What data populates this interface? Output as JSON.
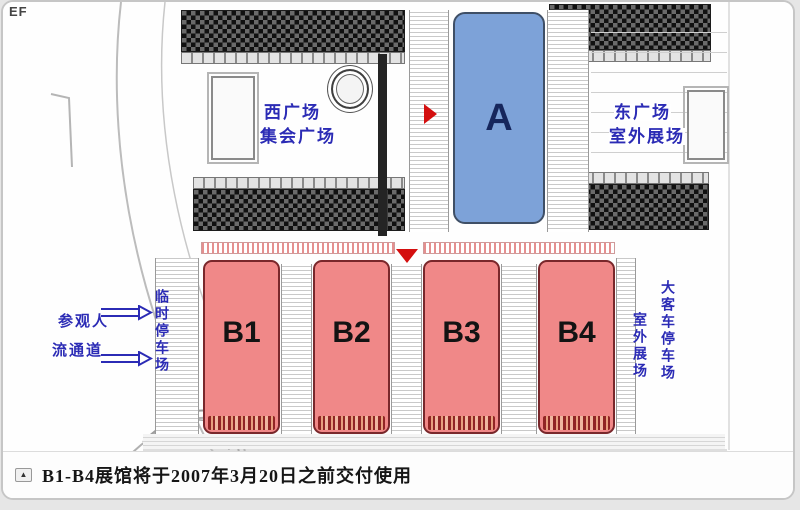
{
  "page": {
    "corner_label": "EF"
  },
  "map": {
    "west_square": {
      "line1": "西广场",
      "line2": "集会广场"
    },
    "east_square": {
      "line1": "东广场",
      "line2": "室外展场"
    },
    "halls": [
      {
        "id": "A",
        "label": "A",
        "fill": "#7da2d8"
      },
      {
        "id": "B1",
        "label": "B1",
        "fill": "#f08888"
      },
      {
        "id": "B2",
        "label": "B2",
        "fill": "#f08888"
      },
      {
        "id": "B3",
        "label": "B3",
        "fill": "#f08888"
      },
      {
        "id": "B4",
        "label": "B4",
        "fill": "#f08888"
      }
    ],
    "left_annotations": {
      "visitor_line1": "参观人",
      "visitor_line2": "流通道",
      "temp_parking": "临时停车场"
    },
    "right_annotations": {
      "outdoor_exhibition": "室外展场",
      "bus_parking": "大客车停车场"
    },
    "colors": {
      "hall_a_fill": "#7da2d8",
      "hall_a_label": "#16265c",
      "hall_b_fill": "#f08888",
      "annotation_blue": "#2b2bb5",
      "marker_red": "#d40f0f"
    }
  },
  "caption": {
    "icon_glyph": "▲",
    "text": "B1-B4展馆将于2007年3月20日之前交付使用"
  }
}
